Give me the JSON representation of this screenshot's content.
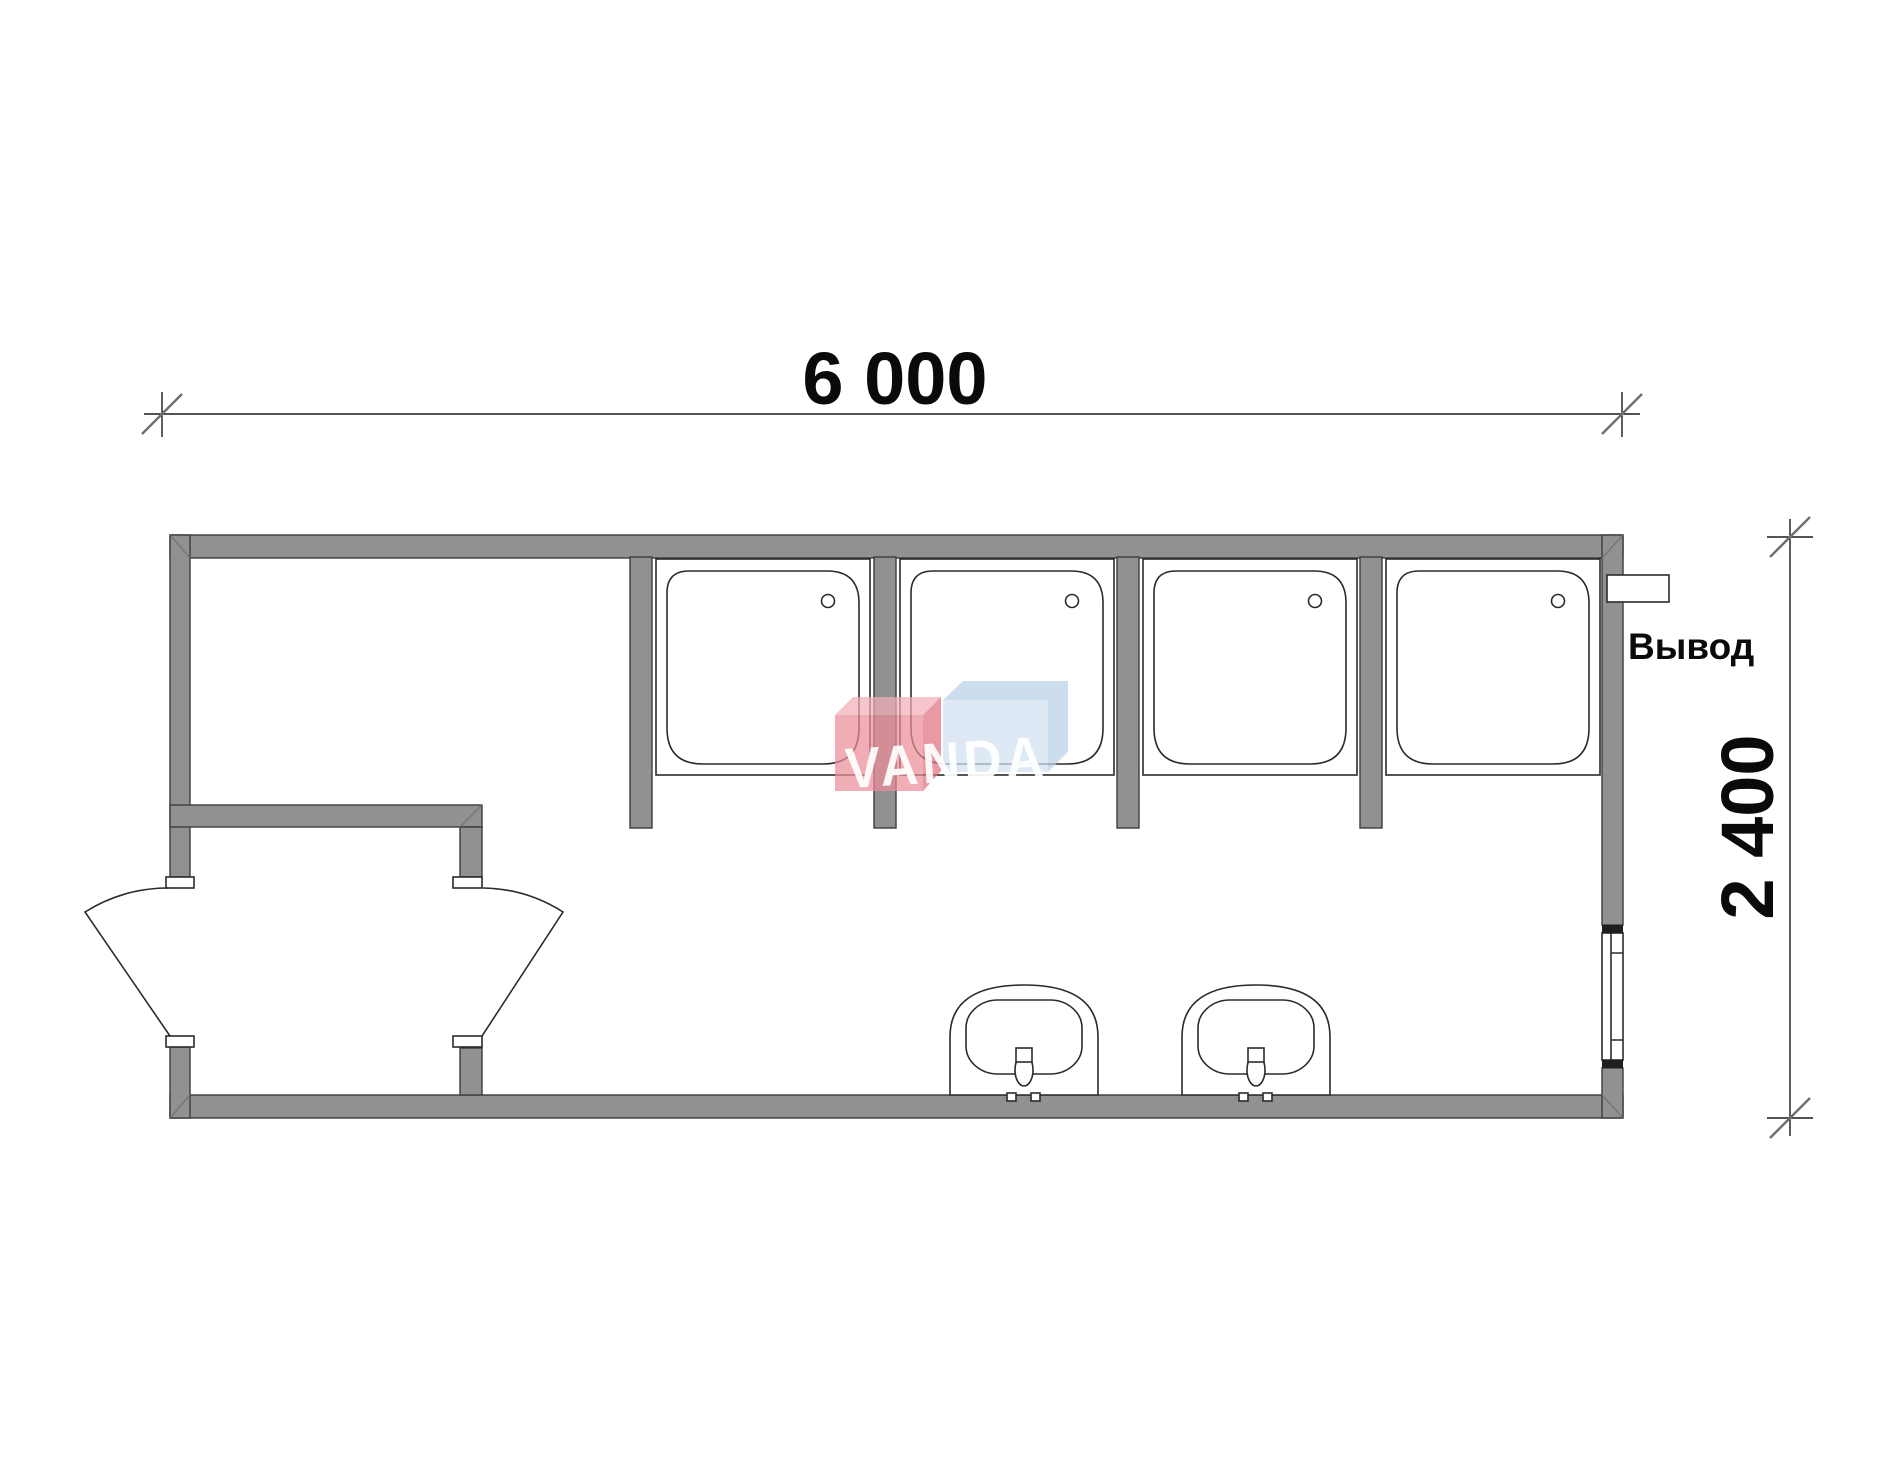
{
  "drawing": {
    "type": "floor-plan",
    "dimensions": {
      "width_label": "6 000",
      "height_label": "2 400"
    },
    "labels": {
      "outlet": "Вывод"
    },
    "watermark": {
      "text": "VANDA",
      "red_front": "#ec8e9a",
      "red_top": "#f2afb8",
      "red_side": "#e1727f",
      "blue_front": "#d3e1f1",
      "blue_top": "#b9d1e8"
    },
    "fixtures": {
      "shower_trays": 4,
      "sinks": 2,
      "door_leaves": 2,
      "windows": 1,
      "outlets": 1
    },
    "colors": {
      "wall_fill": "#919191",
      "wall_outline": "#3c3c3c",
      "line": "#2b2b2b",
      "background": "#ffffff"
    }
  }
}
